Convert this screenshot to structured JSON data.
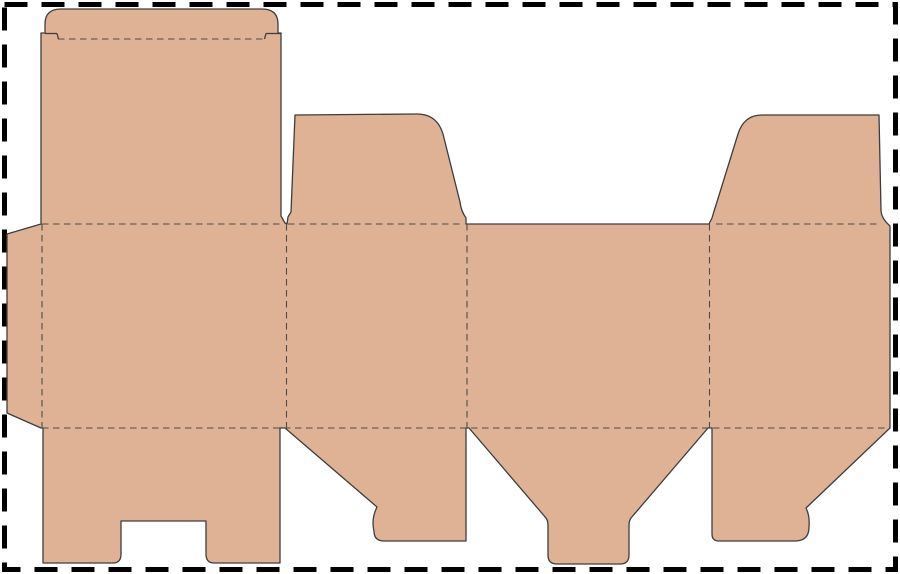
{
  "title": "Folding carton box dieline template",
  "canvas": {
    "width": 900,
    "height": 574,
    "background": "#ffffff"
  },
  "styles": {
    "board_fill": "#E0B295",
    "cut_stroke": "#3d3d3d",
    "cut_width": 1.3,
    "crease_stroke": "#4c4c4c",
    "crease_width": 1.1,
    "crease_dash": "6.5 4.5",
    "border_stroke": "#000000",
    "border_width": 5,
    "border_dash": "23 14",
    "border_inset": 4.5
  },
  "dieline": {
    "silhouette_path": "M41 224 L41 33 L45 33 L45 24 Q45 9 61 9 L262 9 Q278 9 278 24 L278 33 L281 33 L281 216 L285 223 L287 224 L288 217 L291 212 L295 115 L417 114 Q437 114 443 134 L460 202 Q461 211 466 218 L466 224 L709 224 L712 218 Q714 211 716 205 L738 134 Q744 115 762 115 L879 115 L881 210 Q881 218 890 226 L890 428 L806 508 Q810 516 809 527 Q809 541 795 541 L719 541 Q712 541 712 534 L712 428 L708 428 L631 518 Q629 521 629 525 L629 555 Q629 564 620 564 L557 564 Q548 564 548 555 L548 525 Q548 521 546 518 L469 428 L466 428 L466 541 L384 541 Q374 541 374 531 Q371 519 377 507 L285 428 L280 428 L280 563 L214 563 Q206 563 206 554 L206 521 L121 521 L121 554 Q121 563 113 563 L43 563 L43 428 L41 428 L7 413 L7 234 Z",
    "creases": [
      {
        "name": "tuck-flap-fold",
        "x1": 58,
        "y1": 39,
        "x2": 263,
        "y2": 39
      },
      {
        "name": "lid-panel-fold",
        "x1": 42,
        "y1": 224,
        "x2": 281,
        "y2": 224
      },
      {
        "name": "dust-flap-left-fold",
        "x1": 288,
        "y1": 224,
        "x2": 460,
        "y2": 224
      },
      {
        "name": "dust-flap-right-fold",
        "x1": 716,
        "y1": 224,
        "x2": 880,
        "y2": 224
      },
      {
        "name": "glue-flap-fold",
        "x1": 42,
        "y1": 224,
        "x2": 42,
        "y2": 428
      },
      {
        "name": "panel-1-2-fold",
        "x1": 286.5,
        "y1": 224,
        "x2": 286.5,
        "y2": 428
      },
      {
        "name": "panel-2-3-fold",
        "x1": 467,
        "y1": 224,
        "x2": 467,
        "y2": 428
      },
      {
        "name": "panel-3-4-fold",
        "x1": 709.5,
        "y1": 224,
        "x2": 709.5,
        "y2": 428
      },
      {
        "name": "bottom-flaps-fold",
        "x1": 42,
        "y1": 428,
        "x2": 890,
        "y2": 428
      }
    ],
    "cut_marks": [
      {
        "name": "tuck-shoulder-left",
        "x1": 45,
        "y1": 33.5,
        "x2": 57,
        "y2": 33.5
      },
      {
        "name": "tuck-notch-left",
        "x1": 57,
        "y1": 33.5,
        "x2": 58.5,
        "y2": 39
      },
      {
        "name": "tuck-shoulder-right",
        "x1": 266,
        "y1": 33.5,
        "x2": 281,
        "y2": 33.5
      },
      {
        "name": "tuck-notch-right",
        "x1": 264.5,
        "y1": 39,
        "x2": 266,
        "y2": 33.5
      }
    ]
  }
}
